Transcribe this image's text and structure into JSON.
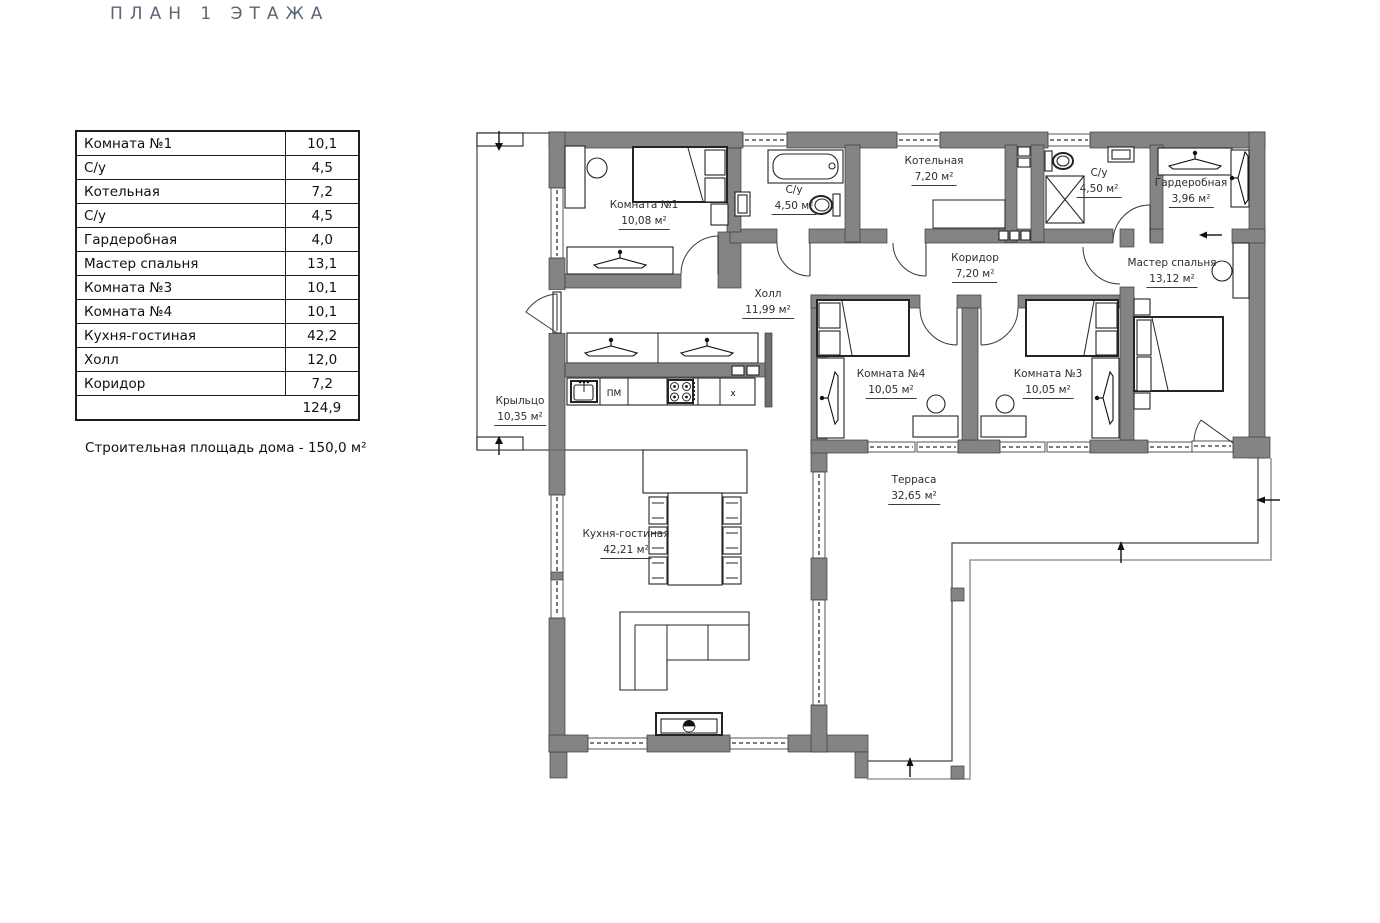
{
  "title": "ПЛАН 1 ЭТАЖА",
  "table": {
    "rows": [
      {
        "label": "Комната №1",
        "value": "10,1"
      },
      {
        "label": "С/у",
        "value": "4,5"
      },
      {
        "label": "Котельная",
        "value": "7,2"
      },
      {
        "label": "С/у",
        "value": "4,5"
      },
      {
        "label": "Гардеробная",
        "value": "4,0"
      },
      {
        "label": "Мастер спальня",
        "value": "13,1"
      },
      {
        "label": "Комната №3",
        "value": "10,1"
      },
      {
        "label": "Комната №4",
        "value": "10,1"
      },
      {
        "label": "Кухня-гостиная",
        "value": "42,2"
      },
      {
        "label": "Холл",
        "value": "12,0"
      },
      {
        "label": "Коридор",
        "value": "7,2"
      }
    ],
    "total": "124,9"
  },
  "note": "Строительная площадь дома - 150,0 м²",
  "plan": {
    "rooms": {
      "komnata1": {
        "name": "Комната №1",
        "area": "10,08 м²"
      },
      "su1": {
        "name": "С/у",
        "area": "4,50 м²"
      },
      "kotelnaya": {
        "name": "Котельная",
        "area": "7,20 м²"
      },
      "su2": {
        "name": "С/у",
        "area": "4,50 м²"
      },
      "garderobnaya": {
        "name": "Гардеробная",
        "area": "3,96 м²"
      },
      "koridor": {
        "name": "Коридор",
        "area": "7,20 м²"
      },
      "master": {
        "name": "Мастер спальня",
        "area": "13,12 м²"
      },
      "holl": {
        "name": "Холл",
        "area": "11,99 м²"
      },
      "komnata4": {
        "name": "Комната №4",
        "area": "10,05 м²"
      },
      "komnata3": {
        "name": "Комната №3",
        "area": "10,05 м²"
      },
      "kryltso": {
        "name": "Крыльцо",
        "area": "10,35 м²"
      },
      "kuhnya": {
        "name": "Кухня-гостиная",
        "area": "42,21 м²"
      },
      "terrasa": {
        "name": "Терраса",
        "area": "32,65 м²"
      }
    },
    "kitchen": {
      "dishwasher": "ПМ",
      "fridge": "х"
    },
    "colors": {
      "wall": "#848484",
      "line": "#2e2e2e",
      "thin": "#9a9a9a"
    }
  }
}
